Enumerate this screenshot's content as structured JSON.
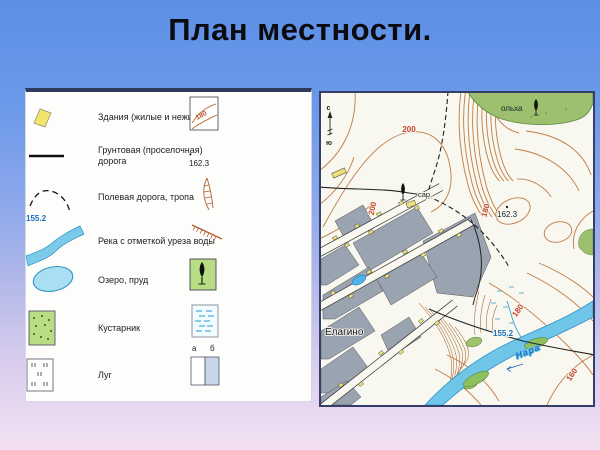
{
  "title": "План местности.",
  "legend": {
    "left": [
      {
        "label": "Здания (жилые и нежилые)"
      },
      {
        "label": "Грунтовая (проселочная) дорога"
      },
      {
        "label": "Полевая дорога, тропа"
      },
      {
        "label": "Река с отметкой уреза воды",
        "mark": "155.2"
      },
      {
        "label": "Озеро, пруд"
      },
      {
        "label": "Кустарник"
      },
      {
        "label": "Луг"
      }
    ],
    "right": [
      {
        "label": "Горизонтали",
        "mark": "180"
      },
      {
        "label": "Отметки высот",
        "mark": "162.3"
      },
      {
        "label": "Овраг"
      },
      {
        "label": "Обрыв"
      },
      {
        "label": "Лес лиственный"
      },
      {
        "label": "Болото"
      },
      {
        "label": "Пашня (а), огород (б)",
        "sub_a": "а",
        "sub_b": "б"
      }
    ]
  },
  "map": {
    "compass": {
      "north": "с",
      "south": "ю"
    },
    "labels": {
      "contour_200_top": "200",
      "contour_200_side": "200",
      "contour_180_mid": "180",
      "contour_180_low": "180",
      "contour_160": "160",
      "height_162": "162.3",
      "water_155": "155.2",
      "barn": "сар.",
      "alder": "ольха",
      "village": "Елагино",
      "river": "Нара"
    }
  },
  "colors": {
    "contour": "#bf7b45",
    "water": "#6fc6e9",
    "forest": "#9cc06e",
    "block_gray": "#9aa3b0",
    "building_yellow": "#ece07b",
    "accent_navy": "#2e3a5e"
  }
}
